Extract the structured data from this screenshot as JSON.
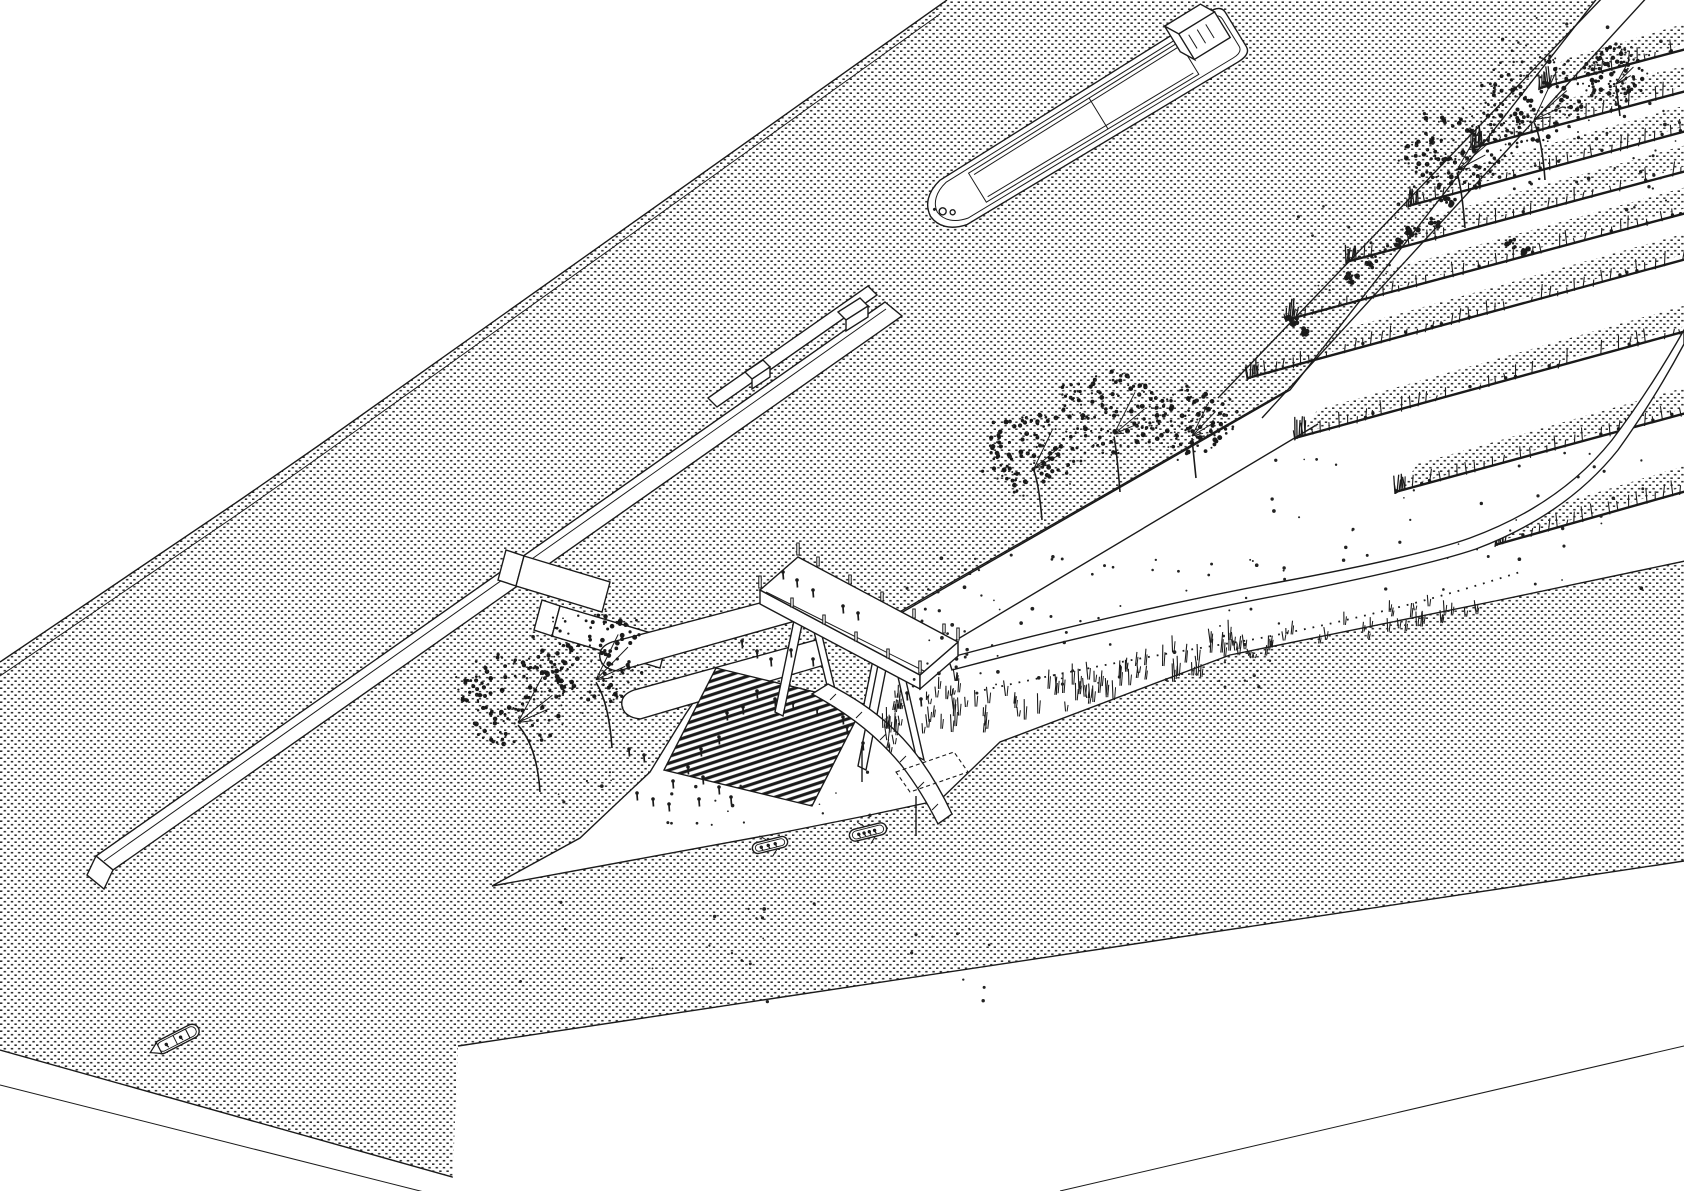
{
  "meta": {
    "title": "Axonometric architectural line drawing of a riverfront landscape: cargo barge on stippled water, stepped quay walls, elevated viewing platform on piles, amphitheater steps to the water, floating gangway with small boats, beach spit with trees, embankment paths and wetland reed cells",
    "drawing_type": "axonometric line drawing",
    "elements": [
      "cargo barge with wheelhouse",
      "far bank flood wall",
      "long quay wall with gate blocks",
      "groyne walls",
      "ramp wedge walls",
      "amphitheater steps",
      "elevated platform on slanted piles",
      "curved floating gangway",
      "dashed pontoon",
      "beach spit",
      "scatter-dot trees",
      "shrub clumps",
      "reed row wetland cells",
      "curved riverside path",
      "dotted foot trail",
      "tall grass slope",
      "rowboats with people",
      "motorboat",
      "crowds of tiny figures"
    ]
  },
  "palette": {
    "paper": "#ffffff",
    "ink": "#1a1a1a",
    "stipple": "#2f2f2f",
    "speck": "#222222"
  },
  "scene": {
    "water": {
      "texture": "dense-stipple-rows"
    },
    "barge": {
      "transform": "translate(928,218) rotate(-31.5)",
      "length": 364,
      "beam": 58
    },
    "trees": [
      {
        "cx": 516,
        "cy": 700,
        "r": 56,
        "bx": 540,
        "by": 792
      },
      {
        "cx": 594,
        "cy": 658,
        "r": 54,
        "bx": 612,
        "by": 748
      },
      {
        "cx": 1032,
        "cy": 450,
        "r": 46,
        "bx": 1042,
        "by": 520
      },
      {
        "cx": 1112,
        "cy": 414,
        "r": 50,
        "bx": 1120,
        "by": 492
      },
      {
        "cx": 1190,
        "cy": 420,
        "r": 40,
        "bx": 1196,
        "by": 478
      },
      {
        "cx": 1455,
        "cy": 150,
        "r": 50,
        "bx": 1465,
        "by": 228
      },
      {
        "cx": 1532,
        "cy": 98,
        "r": 54,
        "bx": 1545,
        "by": 180
      },
      {
        "cx": 1614,
        "cy": 72,
        "r": 30,
        "bx": 1620,
        "by": 116
      }
    ],
    "shrubs": [
      {
        "x": 1447,
        "y": 203,
        "r": 8
      },
      {
        "x": 1436,
        "y": 222,
        "r": 7
      },
      {
        "x": 1414,
        "y": 232,
        "r": 8
      },
      {
        "x": 1396,
        "y": 243,
        "r": 7
      },
      {
        "x": 1372,
        "y": 262,
        "r": 8
      },
      {
        "x": 1352,
        "y": 278,
        "r": 7
      },
      {
        "x": 1292,
        "y": 320,
        "r": 6
      },
      {
        "x": 1304,
        "y": 332,
        "r": 6
      },
      {
        "x": 1512,
        "y": 244,
        "r": 6
      },
      {
        "x": 1526,
        "y": 252,
        "r": 5
      }
    ],
    "reed_rows": [
      {
        "x1": 1540,
        "y1": 88,
        "x2": 1690,
        "y2": 48
      },
      {
        "x1": 1472,
        "y1": 148,
        "x2": 1690,
        "y2": 90
      },
      {
        "x1": 1408,
        "y1": 206,
        "x2": 1690,
        "y2": 130
      },
      {
        "x1": 1346,
        "y1": 262,
        "x2": 1690,
        "y2": 170
      },
      {
        "x1": 1286,
        "y1": 320,
        "x2": 1690,
        "y2": 212
      },
      {
        "x1": 1248,
        "y1": 378,
        "x2": 1690,
        "y2": 258
      },
      {
        "x1": 1295,
        "y1": 438,
        "x2": 1690,
        "y2": 330
      },
      {
        "x1": 1395,
        "y1": 492,
        "x2": 1690,
        "y2": 412
      },
      {
        "x1": 1495,
        "y1": 545,
        "x2": 1690,
        "y2": 490
      }
    ],
    "grass_bands": [
      {
        "x1": 884,
        "y1": 742,
        "x2": 1238,
        "y2": 652,
        "count": 85,
        "spread": 16,
        "hmin": 8,
        "hmax": 22
      },
      {
        "x1": 1238,
        "y1": 652,
        "x2": 1492,
        "y2": 602,
        "count": 36,
        "spread": 12,
        "hmin": 6,
        "hmax": 15
      },
      {
        "x1": 892,
        "y1": 708,
        "x2": 960,
        "y2": 688,
        "count": 18,
        "spread": 9,
        "hmin": 6,
        "hmax": 14
      }
    ],
    "speckles": [
      {
        "x": 900,
        "y": 555,
        "w": 390,
        "h": 140,
        "count": 85
      },
      {
        "x": 540,
        "y": 768,
        "w": 330,
        "h": 62,
        "count": 22
      },
      {
        "x": 520,
        "y": 888,
        "w": 470,
        "h": 115,
        "count": 26
      },
      {
        "x": 1495,
        "y": 12,
        "w": 185,
        "h": 205,
        "count": 55
      },
      {
        "x": 1250,
        "y": 445,
        "w": 410,
        "h": 145,
        "count": 45
      },
      {
        "x": 1290,
        "y": 195,
        "w": 120,
        "h": 120,
        "count": 18
      }
    ],
    "people": [
      [
        783,
        572
      ],
      [
        797,
        580
      ],
      [
        813,
        590
      ],
      [
        843,
        606
      ],
      [
        858,
        613
      ],
      [
        742,
        641
      ],
      [
        757,
        651
      ],
      [
        771,
        659
      ],
      [
        791,
        650
      ],
      [
        813,
        659
      ],
      [
        757,
        691
      ],
      [
        775,
        699
      ],
      [
        743,
        707
      ],
      [
        727,
        713
      ],
      [
        719,
        737
      ],
      [
        701,
        749
      ],
      [
        688,
        767
      ],
      [
        703,
        777
      ],
      [
        719,
        787
      ],
      [
        699,
        799
      ],
      [
        673,
        781
      ],
      [
        731,
        797
      ],
      [
        637,
        793
      ],
      [
        653,
        799
      ],
      [
        669,
        804
      ],
      [
        629,
        749
      ],
      [
        644,
        755
      ],
      [
        793,
        703
      ],
      [
        817,
        709
      ],
      [
        843,
        717
      ],
      [
        907,
        693
      ],
      [
        921,
        699
      ],
      [
        847,
        727
      ],
      [
        863,
        743
      ]
    ],
    "platform_posts": [
      [
        818,
        566,
        9
      ],
      [
        850,
        584,
        9
      ],
      [
        882,
        601,
        9
      ],
      [
        914,
        618,
        9
      ],
      [
        944,
        633,
        9
      ],
      [
        798,
        555,
        12
      ],
      [
        958,
        640,
        12
      ],
      [
        760,
        588,
        12
      ],
      [
        920,
        673,
        12
      ],
      [
        792,
        607,
        9
      ],
      [
        824,
        624,
        9
      ],
      [
        856,
        641,
        9
      ],
      [
        888,
        658,
        9
      ]
    ],
    "boats": [
      {
        "kind": "rowboat",
        "x": 770,
        "y": 845,
        "angle": -14,
        "length": 36,
        "beam": 11,
        "crew": 3
      },
      {
        "kind": "rowboat",
        "x": 868,
        "y": 832,
        "angle": -14,
        "length": 38,
        "beam": 12,
        "crew": 4
      },
      {
        "kind": "motorboat",
        "x": 177,
        "y": 1039,
        "angle": -27,
        "length": 48,
        "beam": 14,
        "crew": 2
      }
    ]
  }
}
